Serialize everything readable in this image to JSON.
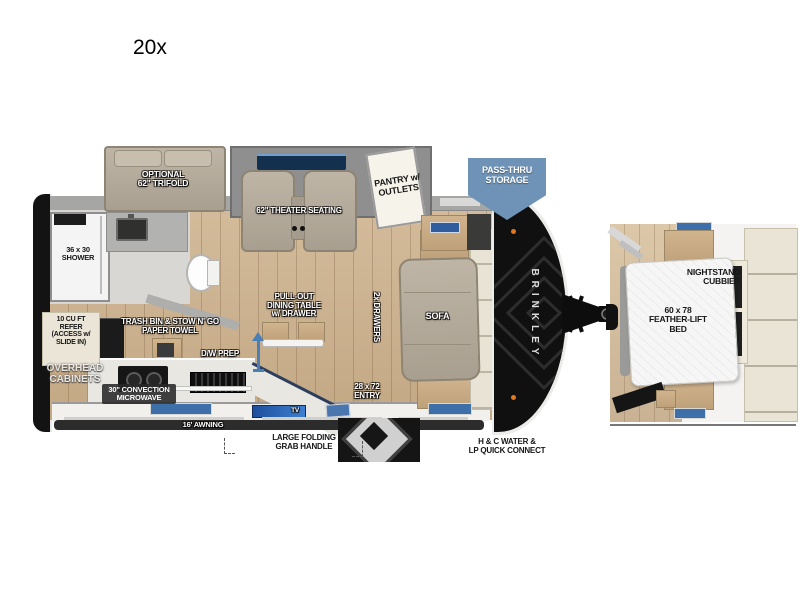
{
  "title": "20x",
  "colors": {
    "wood_floor": "#cbb292",
    "wall_gray": "#a6a6a4",
    "shell_black": "#131313",
    "upholstery_taupe": "#b3a899",
    "badge_blue": "#6e93b7",
    "window_blue": "#2f5d9e",
    "cream_cabinet": "#eae5d7",
    "counter_white": "#e9e7e1",
    "accent_arrow_blue": "#4a7fb5",
    "marker_light_orange": "#e0761e"
  },
  "labels": {
    "trifold": [
      "OPTIONAL",
      "62\" TRIFOLD"
    ],
    "theater": "62\" THEATER SEATING",
    "pantry": [
      "PANTRY w/",
      "OUTLETS"
    ],
    "pass_thru": [
      "PASS-THRU",
      "STORAGE"
    ],
    "shower": [
      "36 x 30",
      "SHOWER"
    ],
    "refer": [
      "10 CU FT",
      "REFER",
      "(ACCESS w/",
      "SLIDE IN)"
    ],
    "trash": [
      "TRASH BIN & STOW N' GO",
      "PAPER TOWEL"
    ],
    "overhead": [
      "OVERHEAD",
      "CABINETS"
    ],
    "microwave": [
      "30\" CONVECTION",
      "MICROWAVE"
    ],
    "dw_prep": "D/W PREP",
    "dining": [
      "PULL-OUT",
      "DINING TABLE",
      "w/ DRAWER"
    ],
    "drawers": "2x DRAWERS",
    "sofa": "SOFA",
    "entry": [
      "28 x 72",
      "ENTRY"
    ],
    "tv": "TV",
    "brand": "BRINKLEY",
    "awning": "16' AWNING",
    "grab": [
      "LARGE FOLDING",
      "GRAB HANDLE"
    ],
    "water": [
      "H & C WATER &",
      "LP QUICK CONNECT"
    ],
    "nightstand": [
      "NIGHTSTAND",
      "CUBBIES"
    ],
    "bed": [
      "60 x 78",
      "FEATHER-LIFT",
      "BED"
    ]
  }
}
